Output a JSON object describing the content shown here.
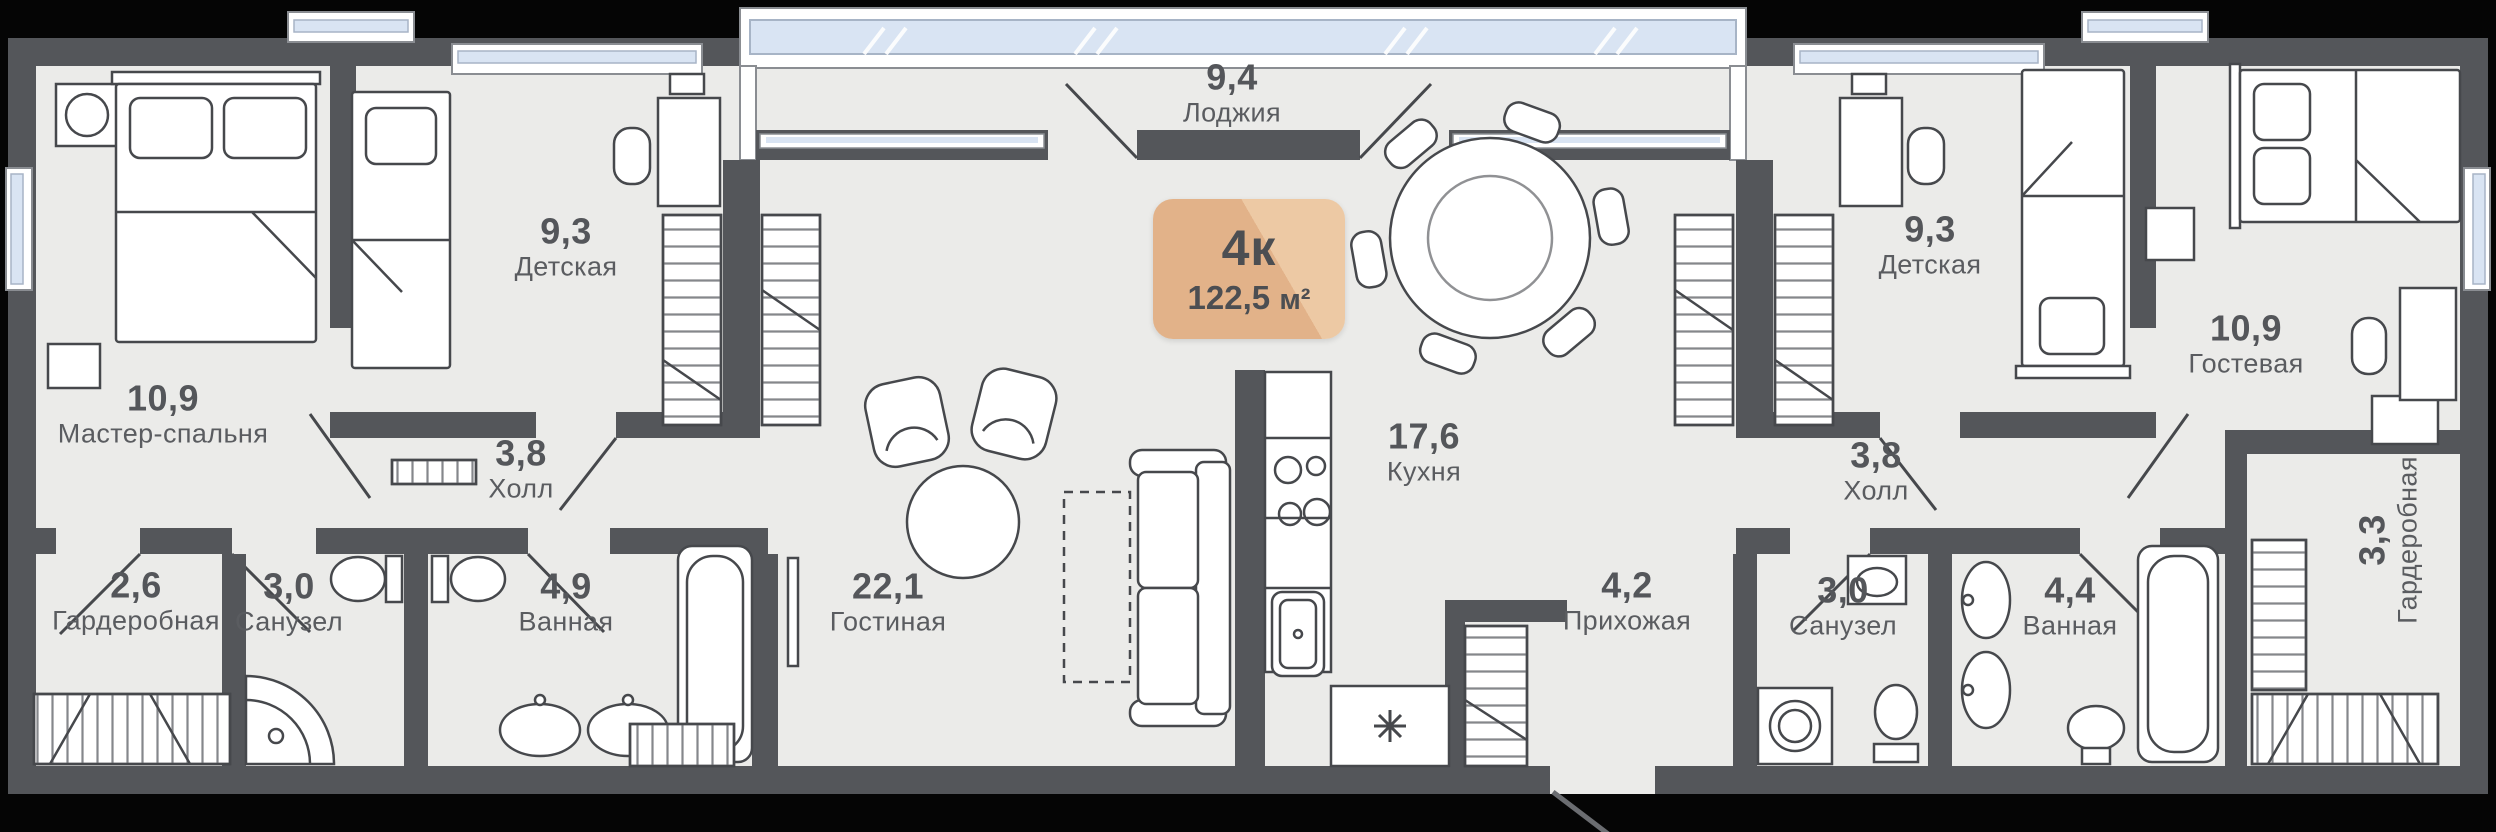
{
  "apartment": {
    "type": "4к",
    "area": "122,5",
    "area_unit": "м²"
  },
  "rooms": [
    {
      "id": "loggia",
      "area": "9,4",
      "name": "Лоджия"
    },
    {
      "id": "master",
      "area": "10,9",
      "name": "Мастер-спальня"
    },
    {
      "id": "kids-left",
      "area": "9,3",
      "name": "Детская"
    },
    {
      "id": "hall-left",
      "area": "3,8",
      "name": "Холл"
    },
    {
      "id": "wardrobe-left",
      "area": "2,6",
      "name": "Гардеробная"
    },
    {
      "id": "wc-left",
      "area": "3,0",
      "name": "Санузел"
    },
    {
      "id": "bath-left",
      "area": "4,9",
      "name": "Ванная"
    },
    {
      "id": "living",
      "area": "22,1",
      "name": "Гостиная"
    },
    {
      "id": "kitchen",
      "area": "17,6",
      "name": "Кухня"
    },
    {
      "id": "entry",
      "area": "4,2",
      "name": "Прихожая"
    },
    {
      "id": "kids-right",
      "area": "9,3",
      "name": "Детская"
    },
    {
      "id": "guest",
      "area": "10,9",
      "name": "Гостевая"
    },
    {
      "id": "hall-right",
      "area": "3,8",
      "name": "Холл"
    },
    {
      "id": "wc-right",
      "area": "3,0",
      "name": "Санузел"
    },
    {
      "id": "bath-right",
      "area": "4,4",
      "name": "Ванная"
    },
    {
      "id": "wardrobe-right",
      "area": "3,3",
      "name": "Гардеробная"
    }
  ],
  "colors": {
    "wall": "#54565a",
    "floor": "#ebebe9",
    "exterior": "#050505",
    "glass": "#d9e4f3",
    "glass_frame": "#ffffff",
    "furniture_stroke": "#46484c",
    "furniture_fill": "#ffffff",
    "badge_bg": "#e2b289",
    "badge_bg_light": "#edc9a4",
    "badge_text": "#4c4e52",
    "label_text": "#54565a",
    "hatch": "#85878b"
  }
}
